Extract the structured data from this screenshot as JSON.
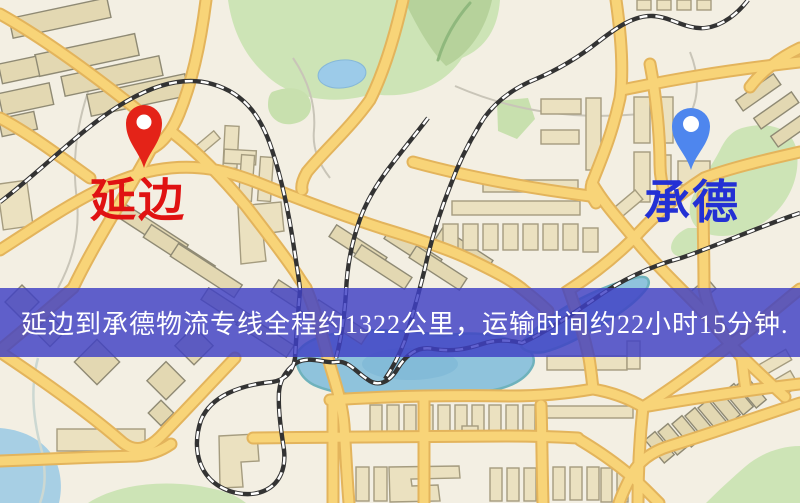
{
  "banner": {
    "text": "延边到承德物流专线全程约1322公里，运输时间约22小时15分钟.",
    "overlay_color": "#3e40c4",
    "text_color": "#ffffff"
  },
  "markers": [
    {
      "name": "延边",
      "role": "origin",
      "pin_color": "#e42318",
      "label_color": "#e01212"
    },
    {
      "name": "承德",
      "role": "destination",
      "pin_color": "#4e86ee",
      "label_color": "#2330d4"
    }
  ],
  "route": {
    "origin": "延边",
    "destination": "承德",
    "distance_text": "约1322公里",
    "duration_text": "约22小时15分钟"
  },
  "map_palette": {
    "background": "#f3efe3",
    "road_fill": "#f8d478",
    "road_casing": "#e3b45c",
    "building": "#ebe1c0",
    "green_area": "#cde4b6",
    "water": "#9ccbe9",
    "railway_dark": "#333333"
  }
}
